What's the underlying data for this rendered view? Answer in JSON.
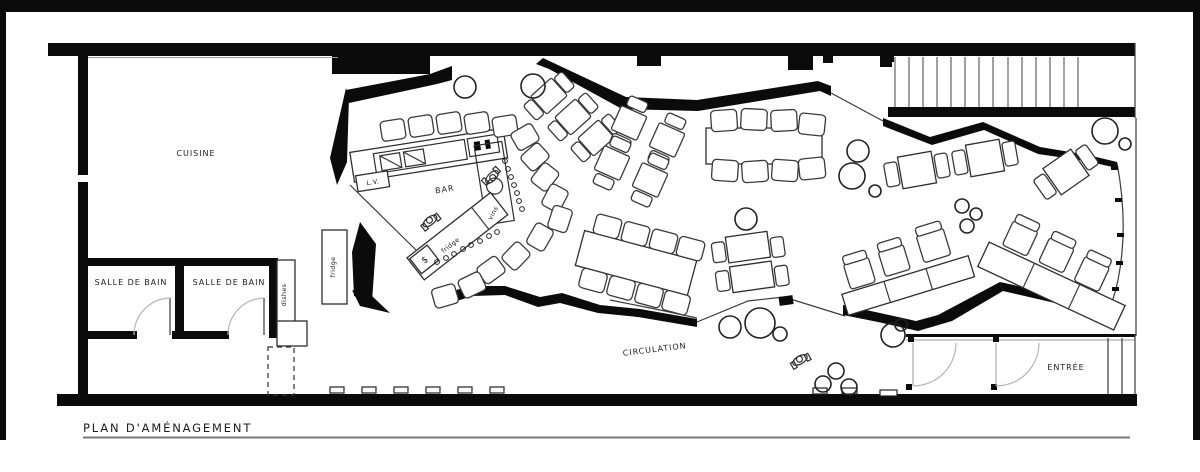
{
  "plan": {
    "title": "PLAN D'AMÉNAGEMENT",
    "labels": {
      "kitchen": "CUISINE",
      "bathroom1": "SALLE DE BAIN",
      "bathroom2": "SALLE DE BAIN",
      "bar": "BAR",
      "dishwasher": "L.V.",
      "bar_fridge": "fridge",
      "wine": "vins",
      "kitchen_fridge": "fridge",
      "dishes": "dishes",
      "cash": "$",
      "circulation": "CIRCULATION",
      "entrance": "ENTRÉE"
    },
    "colors": {
      "wall": "#0b0b0b",
      "line": "#2e2e2e",
      "background": "#ffffff"
    }
  }
}
